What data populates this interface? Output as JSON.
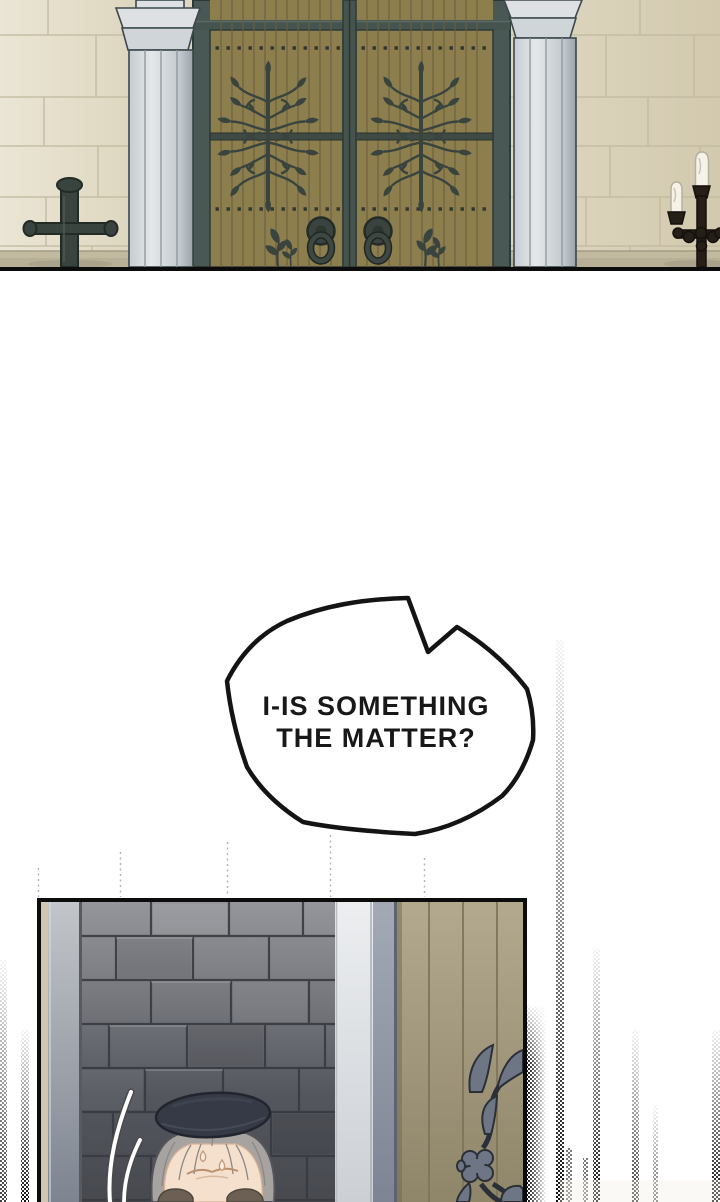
{
  "page": {
    "width": 720,
    "height": 1202,
    "background": "#ffffff"
  },
  "dialogue": {
    "bubble": {
      "line1": "I-IS SOMETHING",
      "line2": "THE MATTER?"
    }
  },
  "theme": {
    "paper": "#ffffff",
    "ink": "#141414",
    "bubble-text": "#181818",
    "stone": "#ded7c0",
    "stone-light": "#ebe5d5",
    "stone-dark": "#d2c9ae",
    "stone-line": "#c3bba1",
    "ground": "#b7af96",
    "pillar-face": "#dde1e4",
    "pillar-shade": "#aeb6bb",
    "pillar-edge": "#3c484c",
    "frame-metal": "#4a5855",
    "frame-dark": "#2e3936",
    "door-wood": "#8d7e4e",
    "door-plank": "#6b5e3d",
    "iron": "#3a443f",
    "candle-metal": "#261f18",
    "candle-wax": "#f6f2e7",
    "brick-top": "#94969b",
    "brick-bottom": "#47494f",
    "brick-line": "#383a41",
    "pillar2-white": "#eceef0",
    "pillar2-gray": "#aeb3ba",
    "pillar2-blue": "#97a0ad",
    "gate-wood": "#aba086",
    "gate-wood-dark": "#8f8569",
    "gate-plank": "#7d745a",
    "gate-iron": "#6e7686",
    "gate-iron-dark": "#2b2f37",
    "beret": "#363a46",
    "beret-dark": "#23252e",
    "hair": "#a6a3a1",
    "hair-line": "#8b8885",
    "skin": "#f4e0cd",
    "skin-line": "#bb8f6c",
    "brow": "#6b6053"
  }
}
